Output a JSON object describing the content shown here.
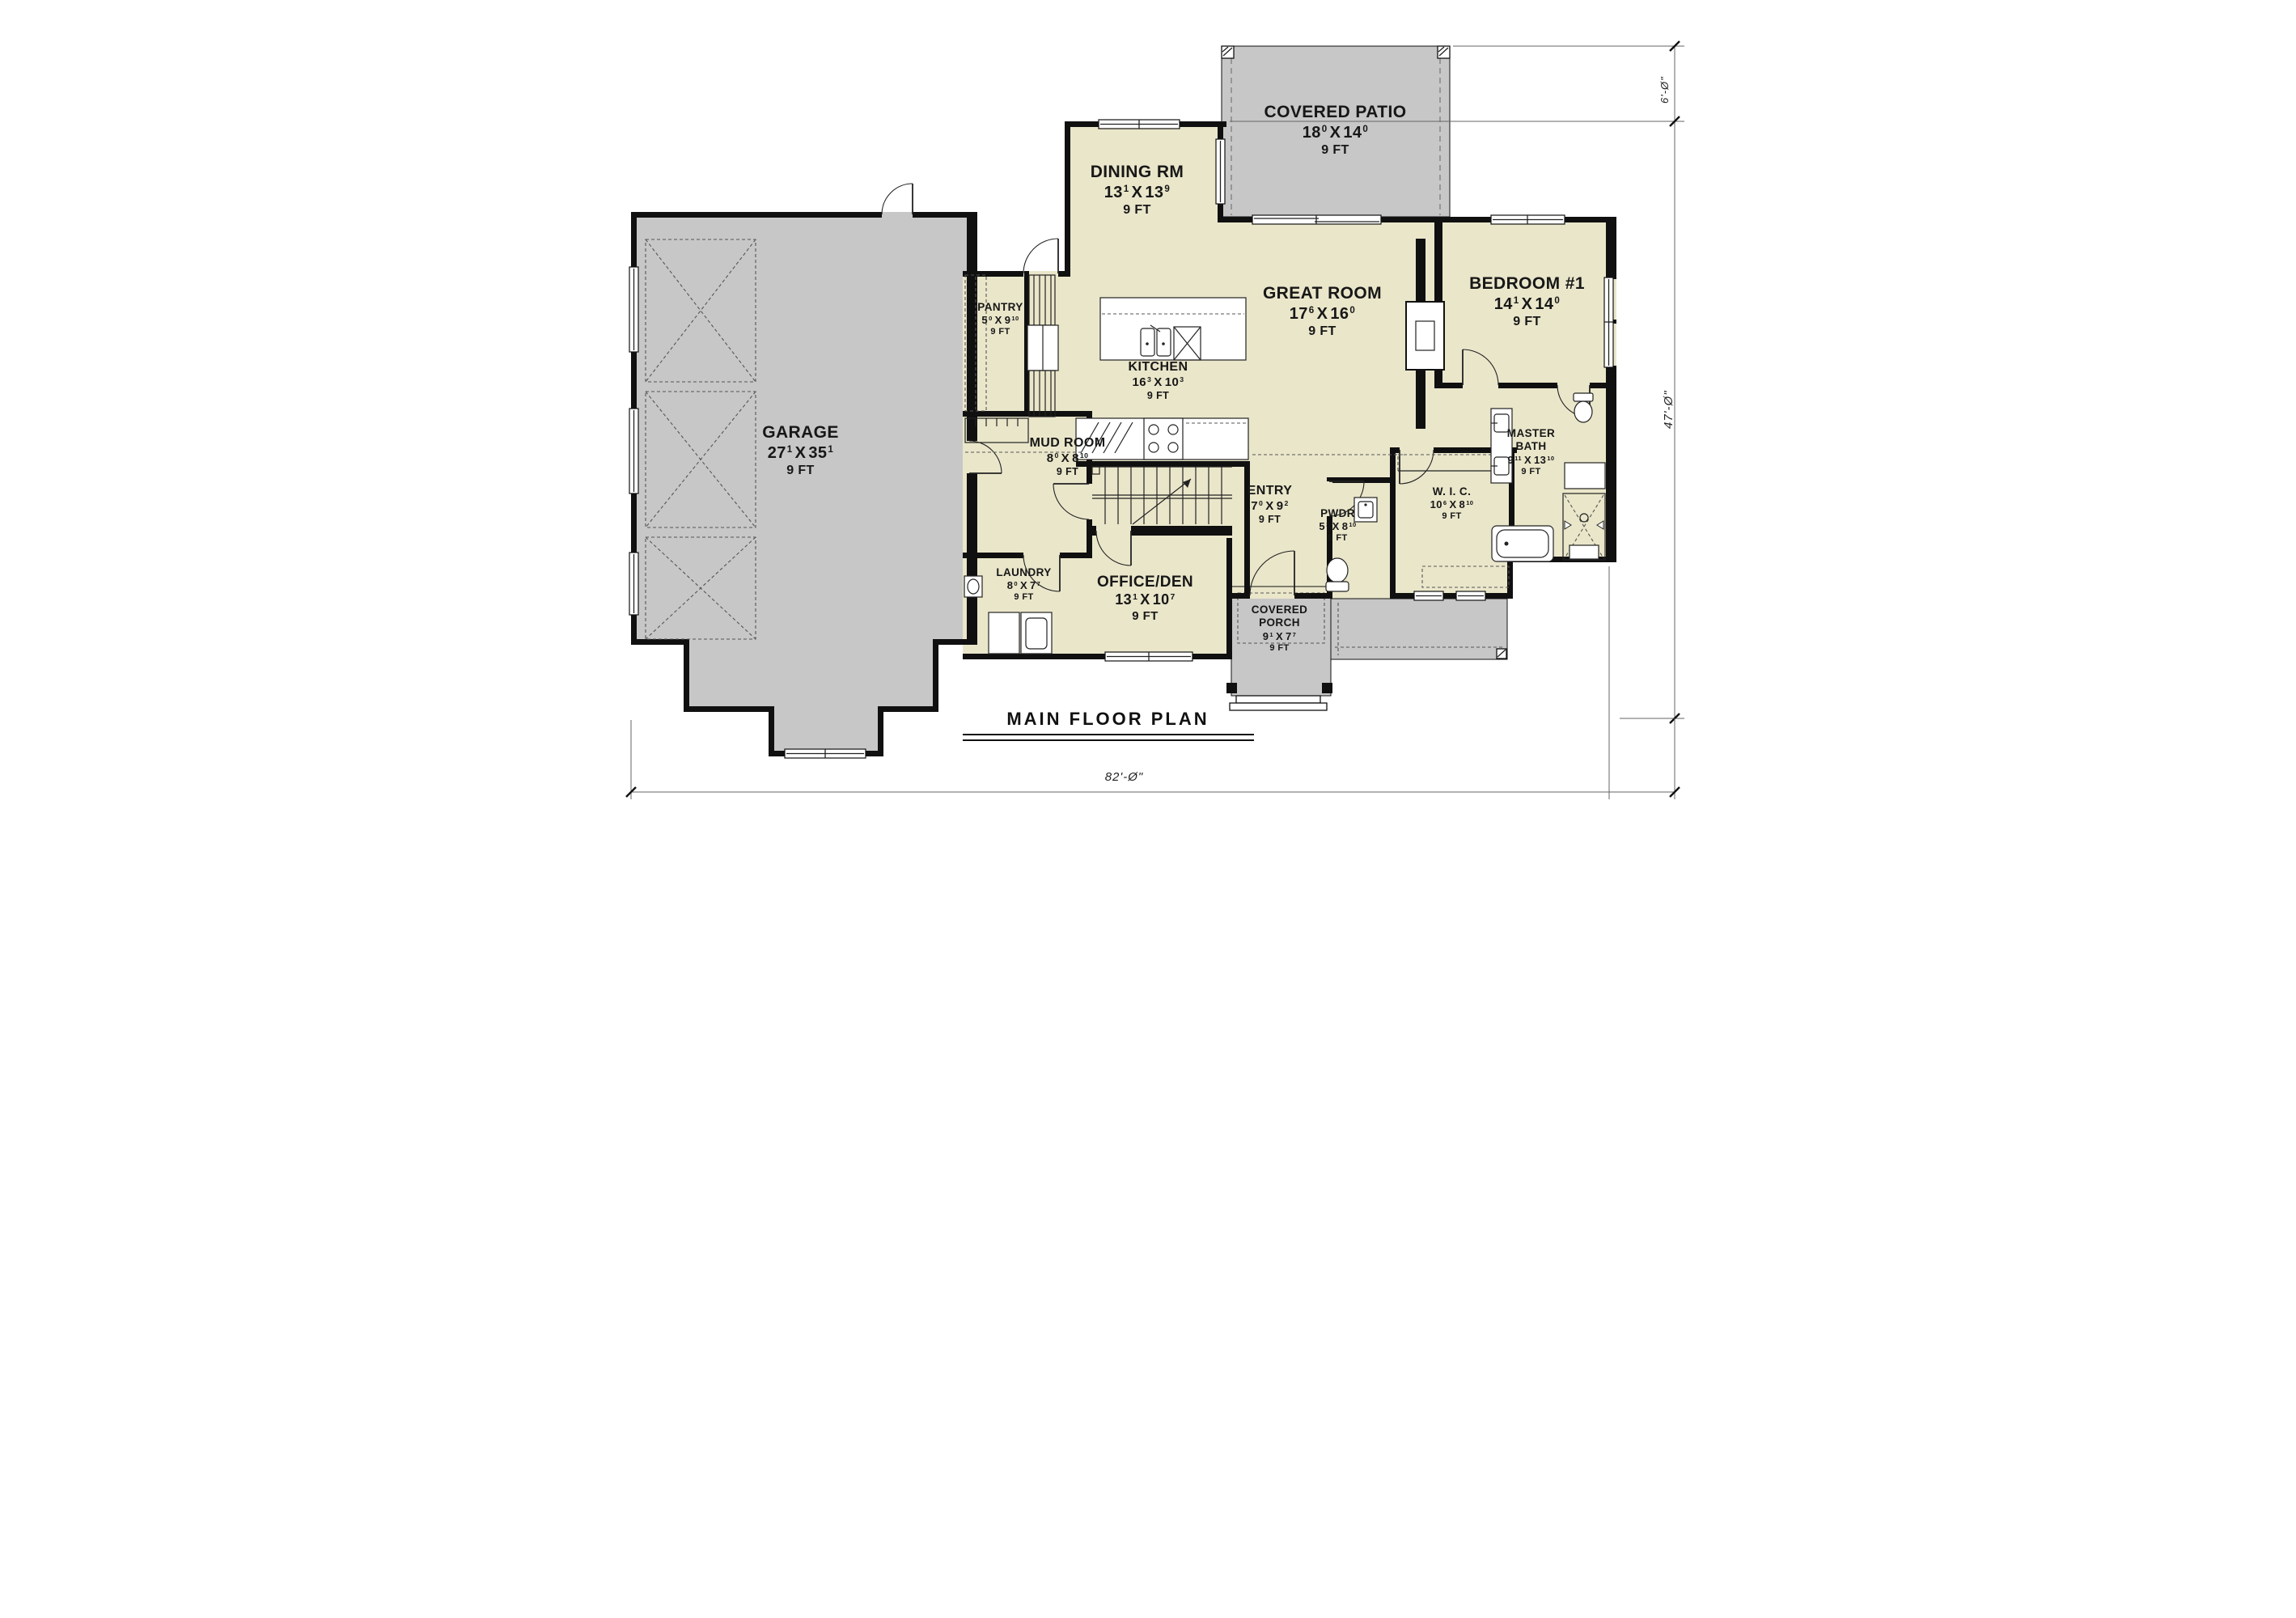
{
  "title": "MAIN FLOOR PLAN",
  "dim_x": "X",
  "rooms": [
    {
      "id": "garage",
      "name": "GARAGE",
      "w": "27",
      "ws": "1",
      "h": "35",
      "hs": "1",
      "ceiling": "9 FT"
    },
    {
      "id": "covered-patio",
      "name": "COVERED PATIO",
      "w": "18",
      "ws": "0",
      "h": "14",
      "hs": "0",
      "ceiling": "9 FT"
    },
    {
      "id": "dining-rm",
      "name": "DINING RM",
      "w": "13",
      "ws": "1",
      "h": "13",
      "hs": "9",
      "ceiling": "9 FT"
    },
    {
      "id": "great-room",
      "name": "GREAT ROOM",
      "w": "17",
      "ws": "6",
      "h": "16",
      "hs": "0",
      "ceiling": "9 FT"
    },
    {
      "id": "bedroom-1",
      "name": "BEDROOM #1",
      "w": "14",
      "ws": "1",
      "h": "14",
      "hs": "0",
      "ceiling": "9 FT"
    },
    {
      "id": "pantry",
      "name": "PANTRY",
      "w": "5",
      "ws": "0",
      "h": "9",
      "hs": "10",
      "ceiling": "9 FT"
    },
    {
      "id": "kitchen",
      "name": "KITCHEN",
      "w": "16",
      "ws": "3",
      "h": "10",
      "hs": "3",
      "ceiling": "9 FT"
    },
    {
      "id": "mud-room",
      "name": "MUD ROOM",
      "w": "8",
      "ws": "0",
      "h": "8",
      "hs": "10",
      "ceiling": "9 FT"
    },
    {
      "id": "entry",
      "name": "ENTRY",
      "w": "7",
      "ws": "0",
      "h": "9",
      "hs": "2",
      "ceiling": "9 FT"
    },
    {
      "id": "pwdr",
      "name": "PWDR",
      "w": "5",
      "ws": "3",
      "h": "8",
      "hs": "10",
      "ceiling": "9 FT"
    },
    {
      "id": "wic",
      "name": "W. I. C.",
      "w": "10",
      "ws": "6",
      "h": "8",
      "hs": "10",
      "ceiling": "9 FT"
    },
    {
      "id": "master-bath",
      "name": "MASTER BATH",
      "w": "9",
      "ws": "11",
      "h": "13",
      "hs": "10",
      "ceiling": "9 FT"
    },
    {
      "id": "laundry",
      "name": "LAUNDRY",
      "w": "8",
      "ws": "0",
      "h": "7",
      "hs": "7",
      "ceiling": "9 FT"
    },
    {
      "id": "office-den",
      "name": "OFFICE/DEN",
      "w": "13",
      "ws": "1",
      "h": "10",
      "hs": "7",
      "ceiling": "9 FT"
    },
    {
      "id": "covered-porch",
      "name": "COVERED PORCH",
      "w": "9",
      "ws": "1",
      "h": "7",
      "hs": "7",
      "ceiling": "9 FT"
    }
  ],
  "overall_dims": {
    "width": "82'-Ø\"",
    "depth": "47'-Ø\"",
    "patio_offset": "6'-Ø\""
  },
  "colors": {
    "wall": "#101010",
    "room_fill": "#EAE6CA",
    "outdoor_fill": "#C7C7C7"
  }
}
